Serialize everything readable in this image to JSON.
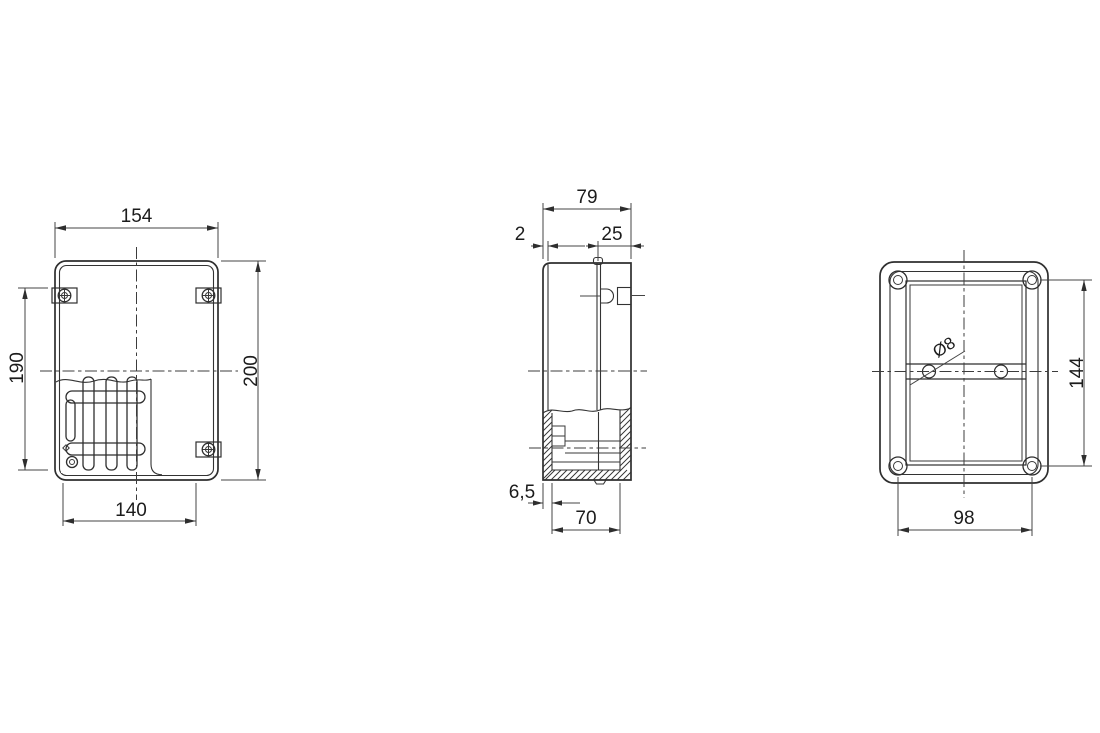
{
  "drawing": {
    "background": "#ffffff",
    "line_color": "#2e2e2e",
    "text_color": "#1c1c1c",
    "views": {
      "front": {
        "name": "front-view",
        "dims": {
          "width_top": "154",
          "height_right": "200",
          "height_left": "190",
          "width_bottom": "140"
        }
      },
      "side": {
        "name": "side-view",
        "dims": {
          "depth_total": "79",
          "lid_thickness": "2",
          "cover_depth": "25",
          "flange_offset": "6,5",
          "base_depth": "70"
        }
      },
      "back": {
        "name": "back-view",
        "dims": {
          "hole_diameter": "Ø8",
          "mount_hole_spacing_v": "144",
          "mount_hole_spacing_h": "98"
        }
      }
    }
  }
}
